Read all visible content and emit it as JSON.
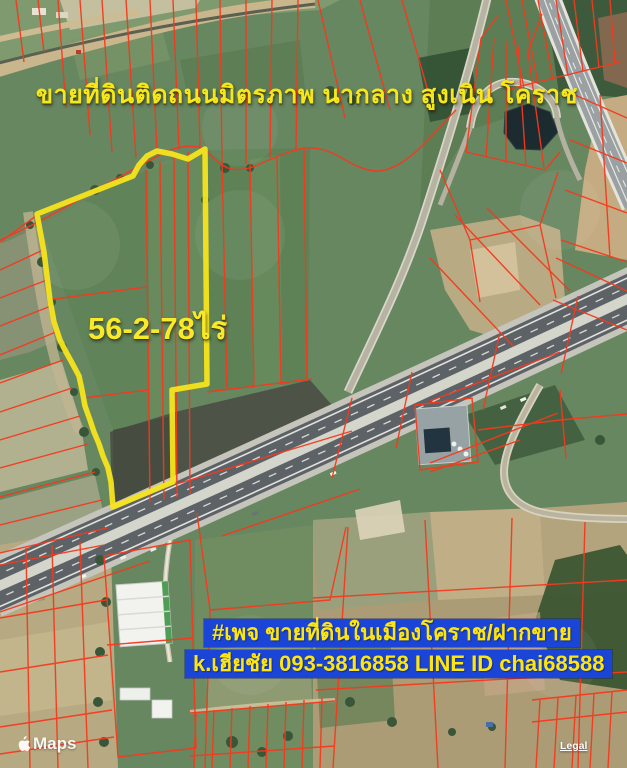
{
  "header": {
    "title": "ขายที่ดินติดถนนมิตรภาพ นากลาง สูงเนิน โคราช"
  },
  "parcel": {
    "area_label": "56-2-78ไร่",
    "outline_color": "#f6e41c"
  },
  "footer": {
    "banner_line1": "#เพจ ขายที่ดินในเมืองโคราช/ฝากขาย",
    "banner_line2": "k.เฮียชัย 093-3816858 LINE ID chai68588",
    "banner_bg_color": "#1a45d6",
    "banner_text_color": "#ffe60a"
  },
  "attribution": {
    "watermark_brand": "Maps",
    "legal_label": "Legal"
  },
  "map": {
    "type": "satellite-with-cadastral-overlay",
    "cadastral_line_color": "#f5391d",
    "title_text_color": "#f5e71a"
  }
}
